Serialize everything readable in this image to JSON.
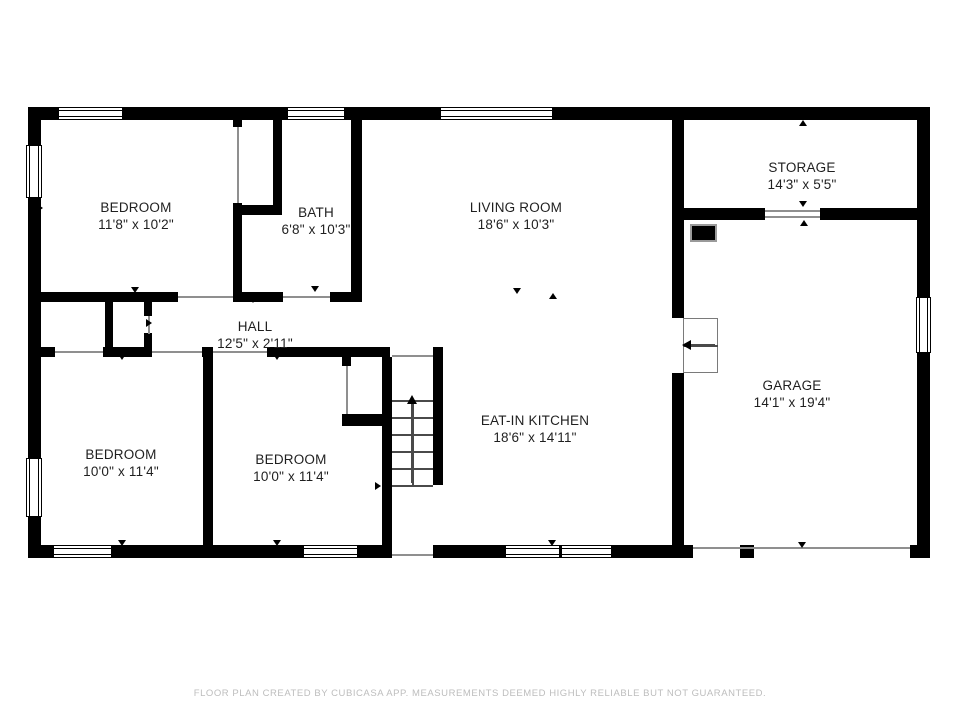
{
  "floor_plan": {
    "footer": "FLOOR PLAN CREATED BY CUBICASA APP. MEASUREMENTS DEEMED HIGHLY RELIABLE BUT NOT GUARANTEED.",
    "colors": {
      "wall": "#000000",
      "door_line": "#8f8f8f",
      "stair_line": "#4a4a4a",
      "label": "#1f1f1f",
      "footer_text": "#bdbdbd"
    },
    "rooms": [
      {
        "id": "bedroom-top-left",
        "name": "BEDROOM",
        "dims": "11'8\" x 10'2\"",
        "cx": 136,
        "cy": 216
      },
      {
        "id": "bath",
        "name": "BATH",
        "dims": "6'8\" x 10'3\"",
        "cx": 316,
        "cy": 221
      },
      {
        "id": "living-room",
        "name": "LIVING ROOM",
        "dims": "18'6\" x 10'3\"",
        "cx": 516,
        "cy": 216
      },
      {
        "id": "storage",
        "name": "STORAGE",
        "dims": "14'3\" x 5'5\"",
        "cx": 802,
        "cy": 176
      },
      {
        "id": "hall",
        "name": "HALL",
        "dims": "12'5\" x 2'11\"",
        "cx": 255,
        "cy": 335
      },
      {
        "id": "eat-in-kitchen",
        "name": "EAT-IN KITCHEN",
        "dims": "18'6\" x 14'11\"",
        "cx": 535,
        "cy": 429
      },
      {
        "id": "garage",
        "name": "GARAGE",
        "dims": "14'1\" x 19'4\"",
        "cx": 792,
        "cy": 394
      },
      {
        "id": "bedroom-bottom-left",
        "name": "BEDROOM",
        "dims": "10'0\" x 11'4\"",
        "cx": 121,
        "cy": 463
      },
      {
        "id": "bedroom-bottom-middle",
        "name": "BEDROOM",
        "dims": "10'0\" x 11'4\"",
        "cx": 291,
        "cy": 468
      }
    ],
    "walls": [
      [
        28,
        107,
        30,
        13
      ],
      [
        123,
        107,
        164,
        13
      ],
      [
        345,
        107,
        95,
        13
      ],
      [
        553,
        107,
        377,
        13
      ],
      [
        28,
        107,
        13,
        38
      ],
      [
        28,
        198,
        13,
        260
      ],
      [
        28,
        517,
        13,
        41
      ],
      [
        917,
        107,
        13,
        190
      ],
      [
        917,
        353,
        13,
        205
      ],
      [
        28,
        545,
        25,
        13
      ],
      [
        112,
        545,
        191,
        13
      ],
      [
        358,
        545,
        28,
        13
      ],
      [
        433,
        545,
        72,
        13
      ],
      [
        612,
        545,
        81,
        13
      ],
      [
        740,
        545,
        14,
        13
      ],
      [
        910,
        545,
        20,
        13
      ],
      [
        233,
        120,
        9,
        7
      ],
      [
        233,
        203,
        9,
        99
      ],
      [
        273,
        120,
        9,
        95
      ],
      [
        233,
        205,
        49,
        10
      ],
      [
        351,
        120,
        11,
        182
      ],
      [
        33,
        292,
        145,
        10
      ],
      [
        233,
        292,
        50,
        10
      ],
      [
        330,
        292,
        32,
        10
      ],
      [
        33,
        347,
        22,
        10
      ],
      [
        103,
        347,
        49,
        10
      ],
      [
        202,
        347,
        11,
        10
      ],
      [
        267,
        347,
        123,
        10
      ],
      [
        433,
        347,
        10,
        138
      ],
      [
        105,
        302,
        8,
        45
      ],
      [
        144,
        302,
        8,
        14
      ],
      [
        144,
        333,
        8,
        14
      ],
      [
        203,
        357,
        10,
        188
      ],
      [
        342,
        357,
        9,
        9
      ],
      [
        342,
        414,
        48,
        12
      ],
      [
        382,
        357,
        10,
        201
      ],
      [
        672,
        120,
        12,
        198
      ],
      [
        672,
        373,
        12,
        172
      ],
      [
        684,
        208,
        81,
        12
      ],
      [
        820,
        208,
        97,
        12
      ]
    ],
    "door_lines": [
      [
        178,
        296,
        55,
        2
      ],
      [
        283,
        296,
        47,
        2
      ],
      [
        237,
        127,
        2,
        76
      ],
      [
        55,
        351,
        48,
        2
      ],
      [
        152,
        351,
        50,
        2
      ],
      [
        213,
        351,
        54,
        2
      ],
      [
        392,
        355,
        41,
        2
      ],
      [
        148,
        316,
        2,
        18
      ],
      [
        346,
        366,
        2,
        48
      ],
      [
        392,
        554,
        41,
        2
      ],
      [
        693,
        547,
        217,
        2
      ],
      [
        765,
        210,
        55,
        2
      ],
      [
        765,
        216,
        55,
        2
      ]
    ],
    "windows": [
      {
        "rect": [
          58,
          107,
          65,
          13
        ],
        "orient": "h"
      },
      {
        "rect": [
          287,
          107,
          58,
          13
        ],
        "orient": "h"
      },
      {
        "rect": [
          440,
          107,
          113,
          13
        ],
        "orient": "h"
      },
      {
        "rect": [
          26,
          145,
          16,
          53
        ],
        "orient": "v"
      },
      {
        "rect": [
          26,
          458,
          16,
          59
        ],
        "orient": "v"
      },
      {
        "rect": [
          916,
          297,
          15,
          56
        ],
        "orient": "v"
      },
      {
        "rect": [
          53,
          545,
          59,
          13
        ],
        "orient": "h"
      },
      {
        "rect": [
          303,
          545,
          55,
          13
        ],
        "orient": "h"
      },
      {
        "rect": [
          505,
          545,
          107,
          13
        ],
        "orient": "h",
        "mullion": 558
      }
    ],
    "markers": [
      [
        135,
        291,
        "down"
      ],
      [
        315,
        290,
        "down"
      ],
      [
        253,
        301,
        "down"
      ],
      [
        122,
        358,
        "down"
      ],
      [
        277,
        358,
        "down"
      ],
      [
        517,
        292,
        "down"
      ],
      [
        553,
        297,
        "up"
      ],
      [
        803,
        124,
        "up"
      ],
      [
        803,
        205,
        "down"
      ],
      [
        804,
        224,
        "up"
      ],
      [
        122,
        544,
        "down"
      ],
      [
        277,
        544,
        "down"
      ],
      [
        552,
        544,
        "down"
      ],
      [
        802,
        546,
        "down"
      ],
      [
        41,
        208,
        "right"
      ],
      [
        357,
        253,
        "right"
      ],
      [
        150,
        323,
        "right"
      ],
      [
        379,
        486,
        "right"
      ],
      [
        681,
        384,
        "left"
      ],
      [
        922,
        163,
        "left"
      ],
      [
        922,
        380,
        "left"
      ]
    ],
    "stairs": {
      "x": 392,
      "w": 41,
      "treads_y": [
        400,
        417,
        434,
        451,
        468,
        485
      ],
      "rail_x": 412,
      "rail_y": [
        400,
        485
      ],
      "arrow": {
        "x": 412,
        "y_head": 395,
        "y1": 404,
        "y2": 483
      }
    },
    "garage_steps": {
      "rect": [
        683,
        318,
        35,
        55
      ],
      "divider_y": 345,
      "arrow_y": 345,
      "arrow_x1": 715,
      "arrow_x2": 690
    },
    "appliance": {
      "rect": [
        690,
        224,
        27,
        18
      ]
    }
  }
}
